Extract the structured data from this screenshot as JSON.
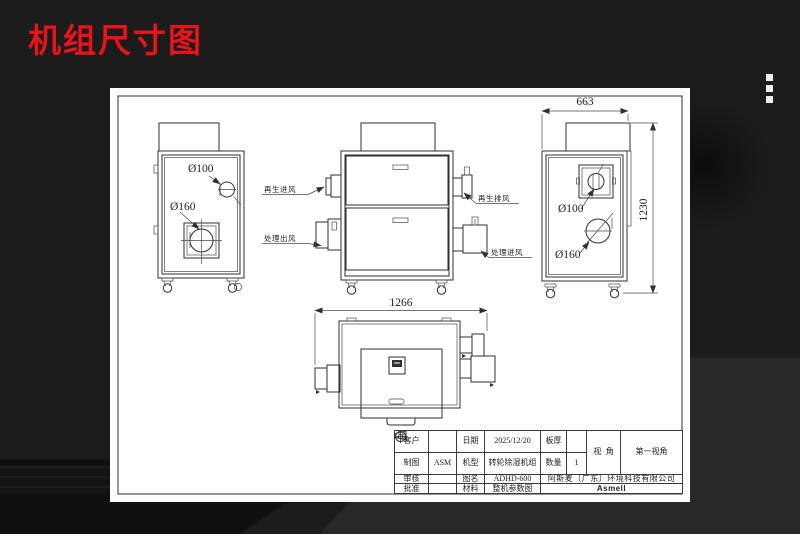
{
  "header": {
    "title": "机组尺寸图"
  },
  "colors": {
    "title_red": "#e8141b",
    "logo_red": "#e60012",
    "sheet_white": "#ffffff",
    "background_dark": "#1c1c1c",
    "line_dark": "#2f2f2f"
  },
  "drawing": {
    "left_view": {
      "d100": "Ø100",
      "d160": "Ø160"
    },
    "front_view": {
      "ports": {
        "regen_in": "再生进风",
        "process_out": "处理出风",
        "regen_out": "再生排风",
        "process_in": "处理进风"
      }
    },
    "plan_view": {
      "width": "1266"
    },
    "right_view": {
      "width": "663",
      "height": "1230",
      "d100": "Ø100",
      "d160": "Ø160"
    }
  },
  "title_block": {
    "customer_label": "客户",
    "customer_value": "",
    "date_label": "日期",
    "date_value": "2025/12/20",
    "thickness_label": "板厚",
    "thickness_value": "",
    "view_angle_label": "视  角",
    "view_angle_value": "第一视角",
    "drafter_label": "制图",
    "drafter_value": "ASM",
    "model_label": "机型",
    "model_value": "转轮除湿机组",
    "qty_label": "数量",
    "qty_value": "1",
    "checker_label": "审核",
    "checker_value": "",
    "name_label": "图名",
    "name_value": "ADHD-600",
    "approver_label": "批准",
    "approver_value": "",
    "material_label": "材料",
    "material_value": "整机参数图",
    "company": "阿斯麦（广东）环境科技有限公司",
    "logo": "Asmell"
  }
}
